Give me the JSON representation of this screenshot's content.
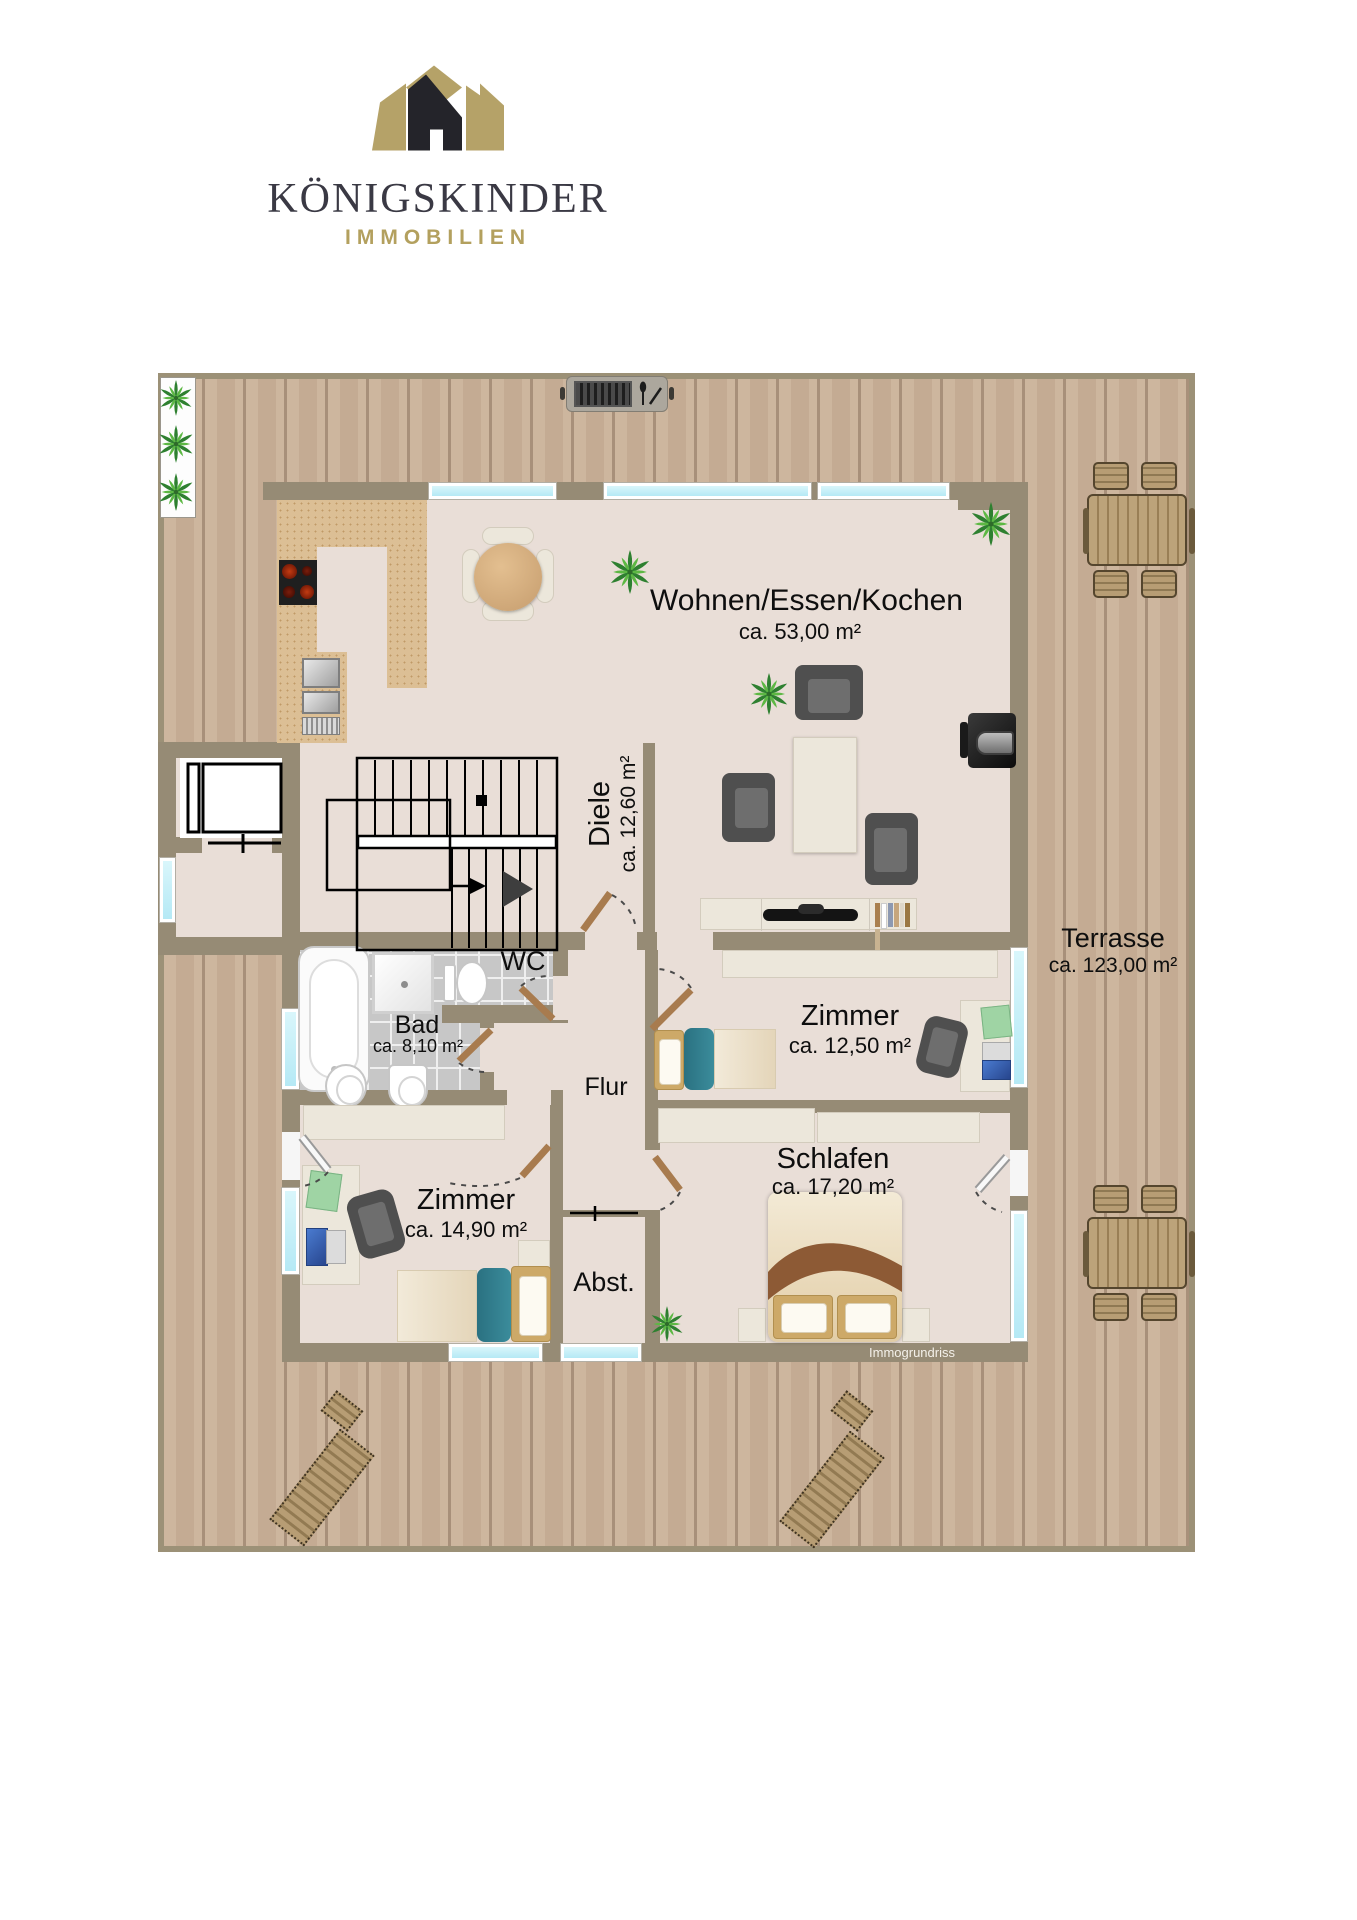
{
  "brand": {
    "logo_icon": "crown-house-icon",
    "name": "KÖNIGSKINDER",
    "tagline": "IMMOBILIEN",
    "colors": {
      "gold": "#b3a05e",
      "ink": "#3a3944"
    }
  },
  "floorplan": {
    "watermark": "Immogrundriss",
    "rooms": {
      "living": {
        "name": "Wohnen/Essen/Kochen",
        "area": "ca. 53,00 m²"
      },
      "hall": {
        "name": "Diele",
        "area": "ca. 12,60 m²"
      },
      "wc": {
        "name": "WC"
      },
      "bath": {
        "name": "Bad",
        "area": "ca. 8,10 m²"
      },
      "corridor": {
        "name": "Flur"
      },
      "room1": {
        "name": "Zimmer",
        "area": "ca. 12,50 m²"
      },
      "sleeping": {
        "name": "Schlafen",
        "area": "ca. 17,20 m²"
      },
      "room2": {
        "name": "Zimmer",
        "area": "ca. 14,90 m²"
      },
      "storage": {
        "name": "Abst."
      },
      "terrace": {
        "name": "Terrasse",
        "area": "ca. 123,00 m²"
      }
    },
    "colors": {
      "wall": "#968b75",
      "floor": "#e9ded7",
      "deck": "#c9b29a",
      "window_glass": "#c3eef8",
      "kitchen_counter": "#dcbf95",
      "tile": "#c7c7c7",
      "door_wood": "#a87b4e",
      "bed_teal": "#2e7e8f"
    }
  }
}
